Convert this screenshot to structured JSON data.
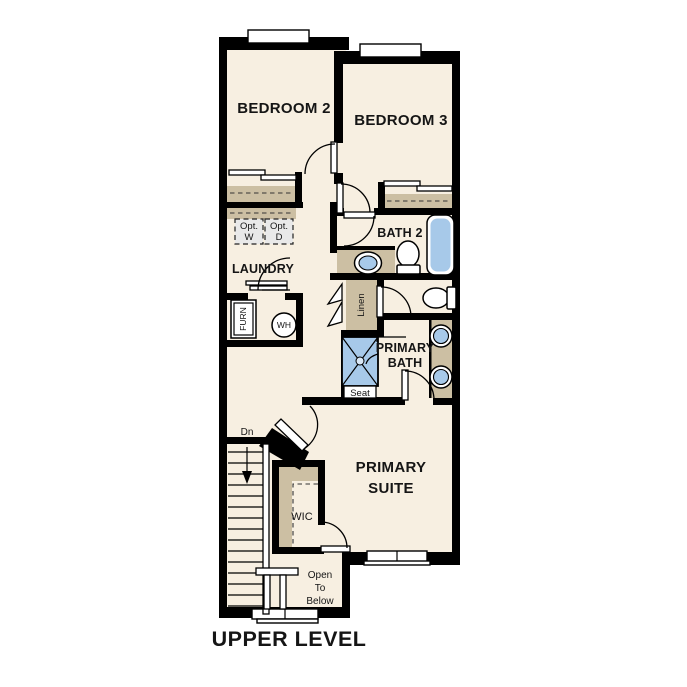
{
  "title": "UPPER LEVEL",
  "rooms": {
    "bedroom2": "BEDROOM 2",
    "bedroom3": "BEDROOM 3",
    "bath2": "BATH 2",
    "laundry": "LAUNDRY",
    "primary_bath_line1": "PRIMARY",
    "primary_bath_line2": "BATH",
    "primary_suite_line1": "PRIMARY",
    "primary_suite_line2": "SUITE",
    "wic": "WIC"
  },
  "fixtures": {
    "furnace": "FURN",
    "water_heater": "WH",
    "linen": "Linen",
    "shower_seat": "Seat",
    "opt_washer_line1": "Opt.",
    "opt_washer_line2": "W",
    "opt_dryer_line1": "Opt.",
    "opt_dryer_line2": "D"
  },
  "stairs": {
    "down_label": "Dn"
  },
  "open_to_below": {
    "line1": "Open",
    "line2": "To",
    "line3": "Below"
  },
  "colors": {
    "floor": "#f7efe1",
    "wall": "#000000",
    "casework_tan": "#ccbfa3",
    "fixture_blue": "#a7c9e9",
    "optional_appliance_gray": "#e9e9e9"
  }
}
